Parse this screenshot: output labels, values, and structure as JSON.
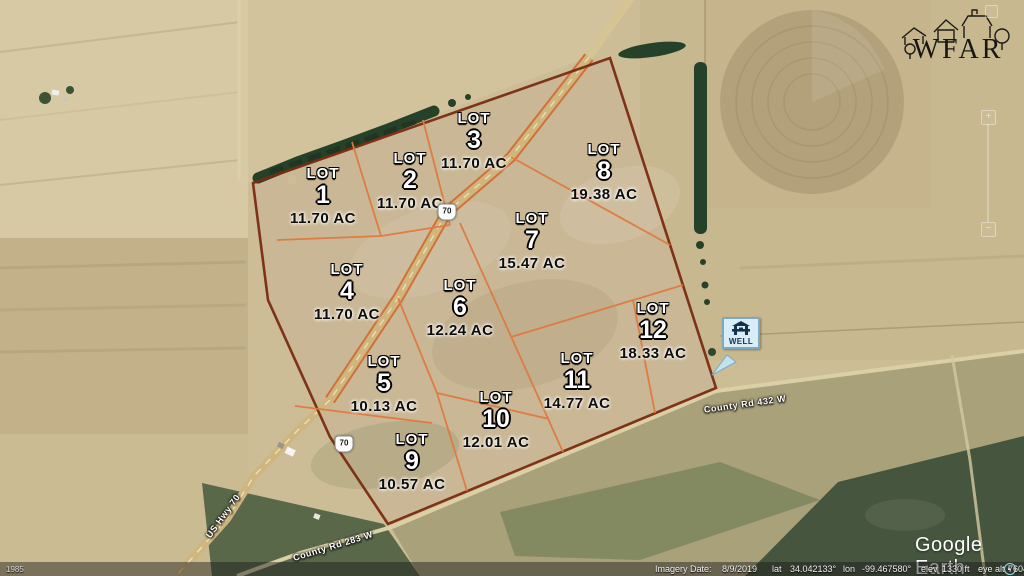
{
  "app": {
    "name": "Google Earth"
  },
  "watermark": {
    "brand": "WFAR"
  },
  "map": {
    "lots": [
      {
        "label": "LOT",
        "number": "1",
        "acreage": "11.70 AC",
        "x": 323,
        "y": 196
      },
      {
        "label": "LOT",
        "number": "2",
        "acreage": "11.70 AC",
        "x": 410,
        "y": 181
      },
      {
        "label": "LOT",
        "number": "3",
        "acreage": "11.70 AC",
        "x": 474,
        "y": 141
      },
      {
        "label": "LOT",
        "number": "4",
        "acreage": "11.70 AC",
        "x": 347,
        "y": 292
      },
      {
        "label": "LOT",
        "number": "5",
        "acreage": "10.13 AC",
        "x": 384,
        "y": 384
      },
      {
        "label": "LOT",
        "number": "6",
        "acreage": "12.24 AC",
        "x": 460,
        "y": 308
      },
      {
        "label": "LOT",
        "number": "7",
        "acreage": "15.47 AC",
        "x": 532,
        "y": 241
      },
      {
        "label": "LOT",
        "number": "8",
        "acreage": "19.38 AC",
        "x": 604,
        "y": 172
      },
      {
        "label": "LOT",
        "number": "9",
        "acreage": "10.57 AC",
        "x": 412,
        "y": 462
      },
      {
        "label": "LOT",
        "number": "10",
        "acreage": "12.01 AC",
        "x": 496,
        "y": 420
      },
      {
        "label": "LOT",
        "number": "11",
        "acreage": "14.77 AC",
        "x": 577,
        "y": 381
      },
      {
        "label": "LOT",
        "number": "12",
        "acreage": "18.33 AC",
        "x": 653,
        "y": 331
      }
    ],
    "road_labels": [
      {
        "name": "US Hwy 70",
        "x": 223,
        "y": 516,
        "rotate": -54
      },
      {
        "name": "County Rd 283 W",
        "x": 333,
        "y": 546,
        "rotate": -17
      },
      {
        "name": "County Rd 432 W",
        "x": 745,
        "y": 404,
        "rotate": -8
      }
    ],
    "highway_shields": [
      {
        "label": "70",
        "x": 447,
        "y": 212
      },
      {
        "label": "70",
        "x": 344,
        "y": 444
      }
    ],
    "well_marker": {
      "label": "WELL"
    }
  },
  "logos": {
    "google_earth": "Google Earth"
  },
  "nav_controls": {
    "zoom_in": "+",
    "zoom_out": "−"
  },
  "status_bar": {
    "history_year": "1985",
    "imagery_date_label": "Imagery Date:",
    "imagery_date": "8/9/2019",
    "lat_label": "lat",
    "lat": "34.042133°",
    "lon_label": "lon",
    "lon": "-99.467580°",
    "elev_label": "elev",
    "elev": "1330 ft",
    "eye_alt_label": "eye alt",
    "eye_alt": "7604 ft"
  }
}
